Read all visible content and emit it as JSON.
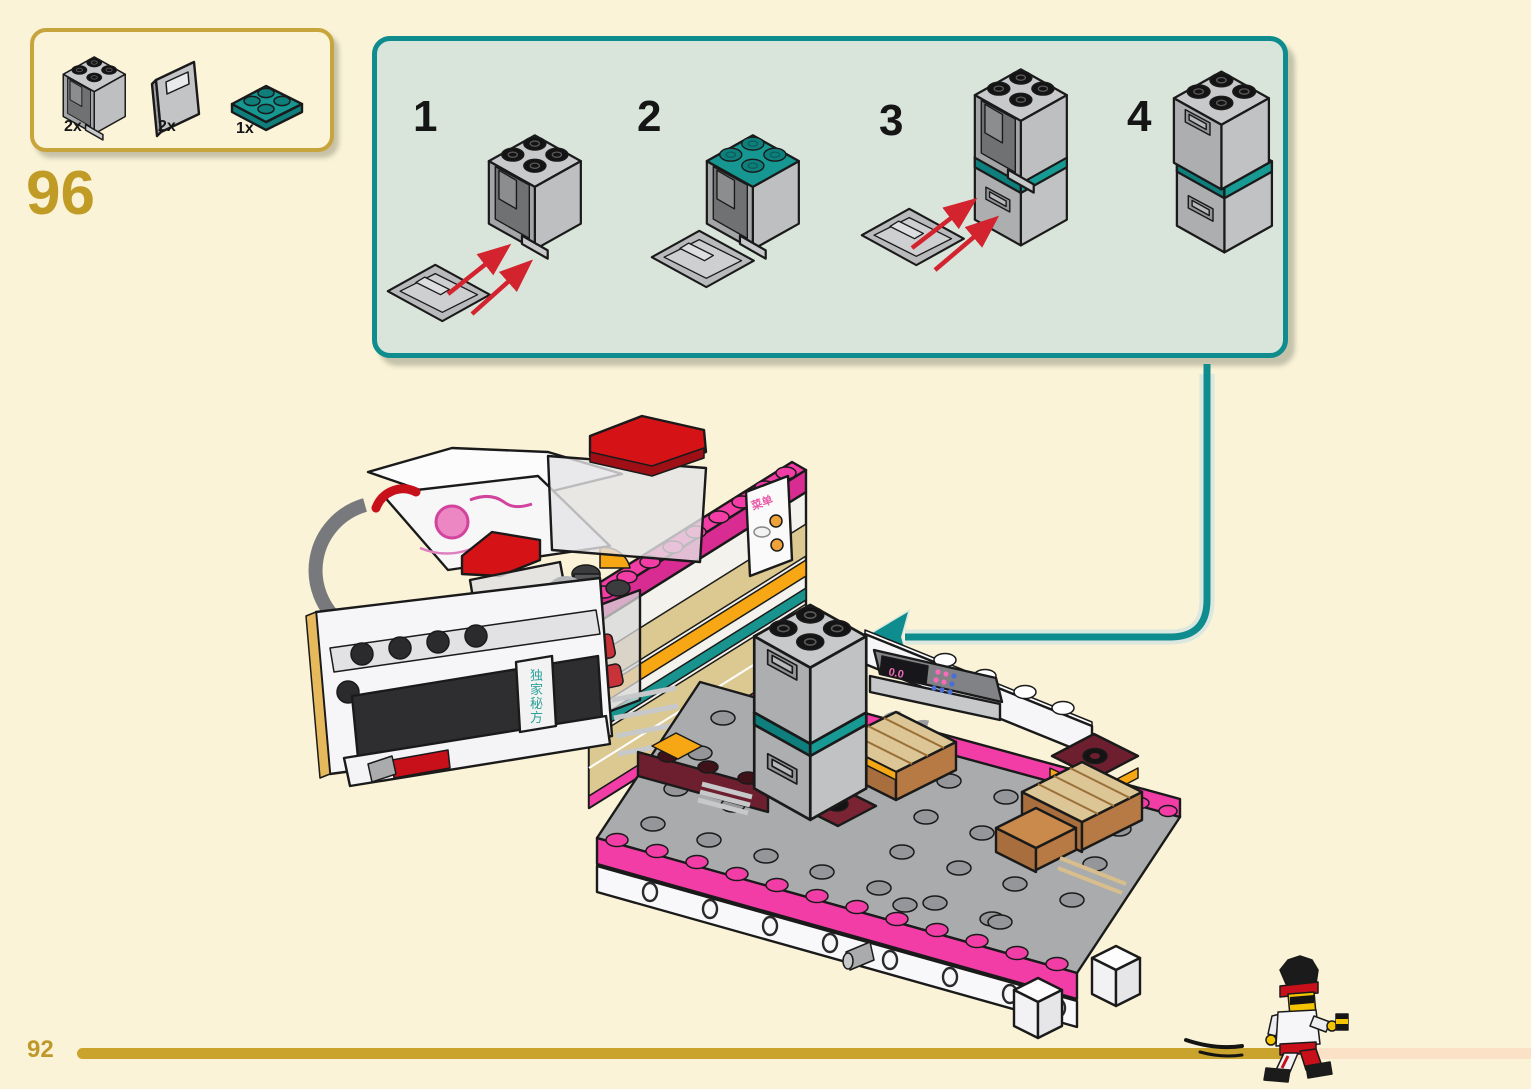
{
  "page": {
    "number": "92",
    "step_number": "96"
  },
  "parts_box": {
    "items": [
      {
        "count": "2x",
        "part": "container-2x2x2-gray"
      },
      {
        "count": "2x",
        "part": "container-door-2x2-gray"
      },
      {
        "count": "1x",
        "part": "plate-2x2-dark-turquoise"
      }
    ]
  },
  "substeps": {
    "labels": [
      "1",
      "2",
      "3",
      "4"
    ]
  },
  "model": {
    "register_display": "0.0",
    "menu_sign_label": "菜单",
    "front_sign_chars": [
      "独",
      "家",
      "秘",
      "方"
    ]
  },
  "progress": {
    "percent_complete": 83
  },
  "colors": {
    "background": "#FAF3D7",
    "panel_background": "#D9E4DB",
    "accent_teal": "#0F8D8E",
    "accent_gold": "#C09B25",
    "brand_pink": "#F23DA6",
    "lego_red": "#D51317",
    "progress_fill": "#C9A32C",
    "progress_remaining": "#FBE2C7"
  }
}
